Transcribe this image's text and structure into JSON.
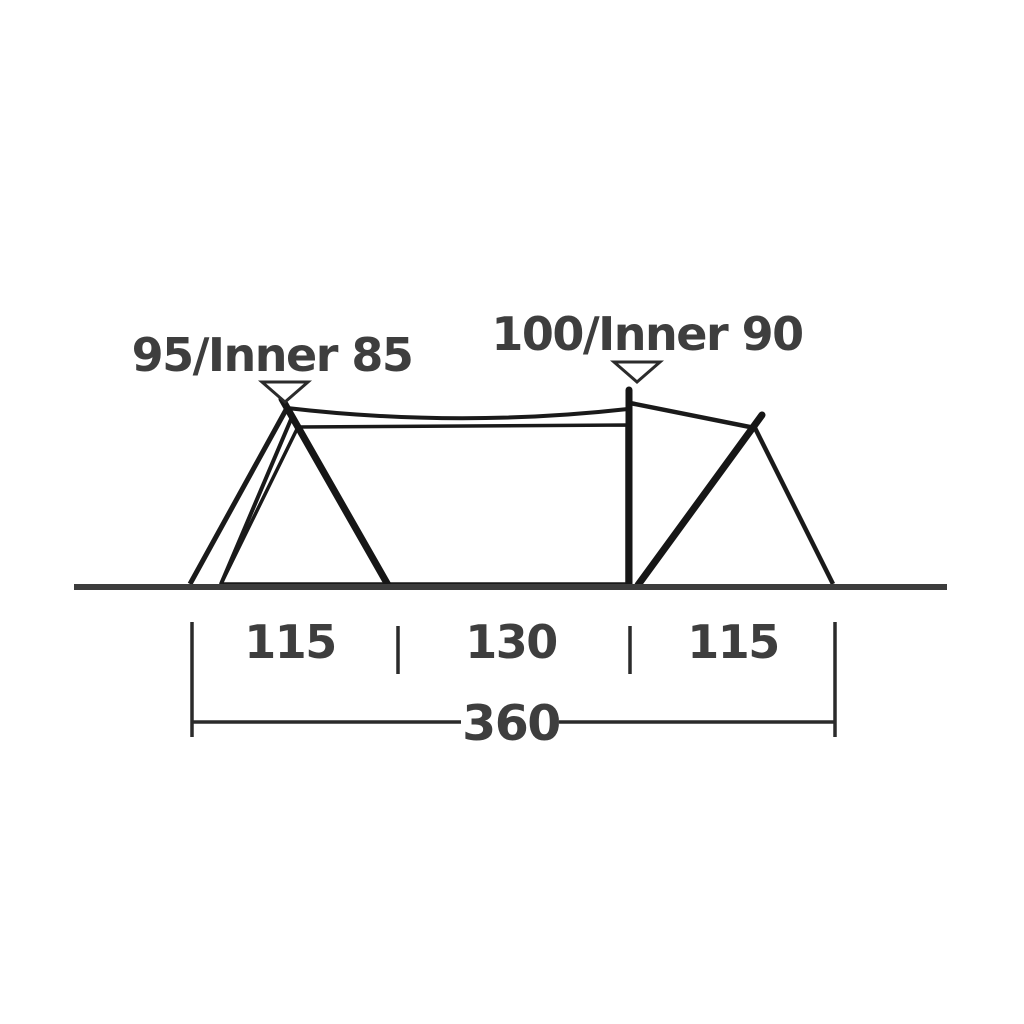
{
  "diagram": {
    "type": "tent-side-profile-dimension-drawing",
    "peak_labels": {
      "left": "95/Inner 85",
      "middle": "100/Inner 90"
    },
    "section_dimensions": [
      "115",
      "130",
      "115"
    ],
    "total_dimension": "360",
    "colors": {
      "background": "#ffffff",
      "tent_line": "#1a1a1a",
      "inner_fill": "#c6c8c7",
      "ground": "#3c3c3c",
      "dimension_line": "#2b2b2b",
      "text": "#3e3e3e"
    }
  }
}
